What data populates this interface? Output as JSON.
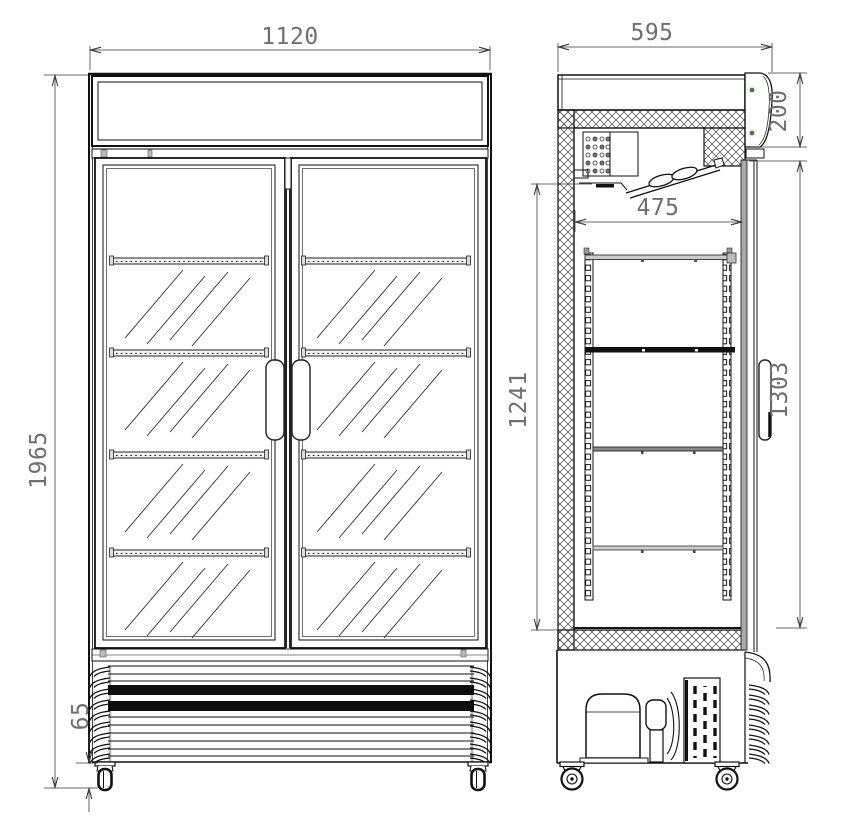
{
  "title": "Refrigerated display cabinet technical drawing",
  "views": {
    "front": {
      "name": "front elevation",
      "doors": 2,
      "shelves_per_door": 4
    },
    "side": {
      "name": "side section",
      "shelves": 4
    }
  },
  "dimensions": {
    "front_width": {
      "value": "1120"
    },
    "overall_height": {
      "value": "1965"
    },
    "base_height": {
      "value": "65"
    },
    "depth": {
      "value": "595"
    },
    "canopy_height": {
      "value": "200"
    },
    "interior_depth": {
      "value": "475"
    },
    "interior_height": {
      "value": "1241"
    },
    "door_height": {
      "value": "1303"
    }
  },
  "colors": {
    "line": "#111111",
    "dimension_line": "#3a3a3a",
    "dimension_text": "#6f6f6f",
    "screw_green": "#3f7d3a",
    "glass_gray": "#a9a9a9",
    "shelf_dark": "#111111"
  }
}
